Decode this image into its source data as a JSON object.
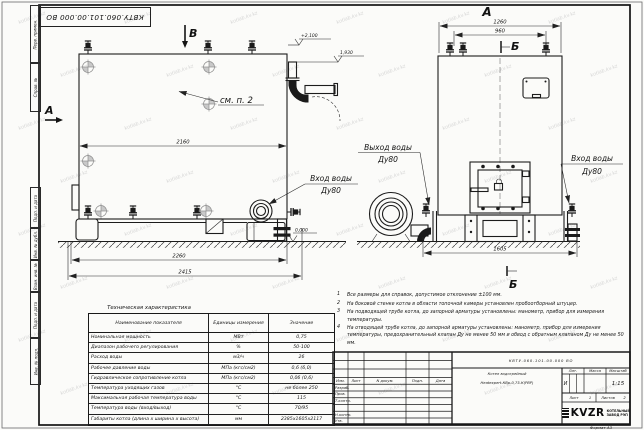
{
  "watermark": {
    "text": "kotlab.kv.kz"
  },
  "frame": {
    "stamp_rotated": "КВТУ.060.101.00.000 ВО",
    "margin_labels": [
      "Перв. примен.",
      "Справ. №",
      "Подп. и дата",
      "Инв. № дубл.",
      "Взам. инв. №",
      "Подп. и дата",
      "Инв. № подл."
    ],
    "format_note": "Формат А3"
  },
  "views": {
    "side": {
      "view_arrow_a": "А",
      "view_arrow_b": "В",
      "dim_top_width": "2160",
      "dim_mid_width": "2260",
      "dim_base_width": "2415",
      "level_top": "+2,100",
      "level_outlet": "1,930",
      "level_ground": "0,000",
      "see_note": "см. п. 2",
      "inlet_line1": "Вход воды",
      "inlet_line2": "Ду80"
    },
    "front": {
      "label_a": "А",
      "label_b_top": "Б",
      "label_b_bottom": "Б",
      "dim_1260": "1260",
      "dim_960": "960",
      "dim_1605": "1605",
      "outlet_line1": "Выход воды",
      "outlet_line2": "Ду80",
      "inlet_line1": "Вход воды",
      "inlet_line2": "Ду80"
    }
  },
  "notes": {
    "items": [
      {
        "num": "1",
        "text": "Все размеры для справок, допустимое отклонение ±100 мм."
      },
      {
        "num": "2",
        "text": "На боковой стенке котла в области топочной камеры установлен пробоотборный штуцер."
      },
      {
        "num": "3",
        "text": "На подводящей трубе котла, до запорной арматуры установлены: манометр, прибор для измерения температуры."
      },
      {
        "num": "4",
        "text": "На отводящей трубе котла, до запорной арматуры установлены: манометр, прибор для измерения температуры, предохранительный клапан Ду не менее 50 мм и обвод с обратным клапаном Ду не менее 50 мм."
      }
    ]
  },
  "spec_table": {
    "title": "Техническая характеристика",
    "headers": {
      "name": "Наименование показателя",
      "units": "Единицы измерения",
      "value": "Значение"
    },
    "rows": [
      {
        "name": "Номинальная мощность",
        "units": "МВт",
        "value": "0,75"
      },
      {
        "name": "Диапазон рабочего регулирования",
        "units": "%",
        "value": "50-100"
      },
      {
        "name": "Расход воды",
        "units": "м3/ч",
        "value": "26"
      },
      {
        "name": "Рабочее давление воды",
        "units": "МПа (кгс/см2)",
        "value": "0,6 (6,0)"
      },
      {
        "name": "Гидравлическое сопротивление котла",
        "units": "МПа (кгс/см2)",
        "value": "0,06 (0,6)"
      },
      {
        "name": "Температура уходящих газов",
        "units": "°С",
        "value": "не более 250"
      },
      {
        "name": "Максимальная рабочая температура воды",
        "units": "°С",
        "value": "115"
      },
      {
        "name": "Температура воды (вход/выход)",
        "units": "°С",
        "value": "70/95"
      },
      {
        "name": "Габариты котла (длина х ширина х высота)",
        "units": "мм",
        "value": "2385х1605х2117"
      }
    ]
  },
  "title_block": {
    "doc_number": "КВТУ.060.101.00.000  ВО",
    "product_name_line1": "Котел водогрейный",
    "product_name_line2": "Heatexpert-КВр-0,75-К(РВР)",
    "cols": {
      "izm": "Изм.",
      "list": "Лист",
      "doc": "N докум.",
      "sign": "Подп.",
      "date": "Дата"
    },
    "roles": {
      "designer": "Разраб.",
      "checker": "Пров.",
      "tcontrol": "Т.контр.",
      "ncontrol": "Н.контр.",
      "approver": "Утв."
    },
    "lit_label": "Лит.",
    "lit_value": "И",
    "mass_label": "Масса",
    "scale_label": "Масштаб",
    "scale_value": "1:15",
    "sheet_label": "Лист",
    "sheet_value": "1",
    "sheets_label": "Листов",
    "sheets_value": "2",
    "logo_text": "KVZR",
    "brand_line1": "КОТЕЛЬНЫЙ",
    "brand_line2": "ЗАВОД РЭП"
  }
}
